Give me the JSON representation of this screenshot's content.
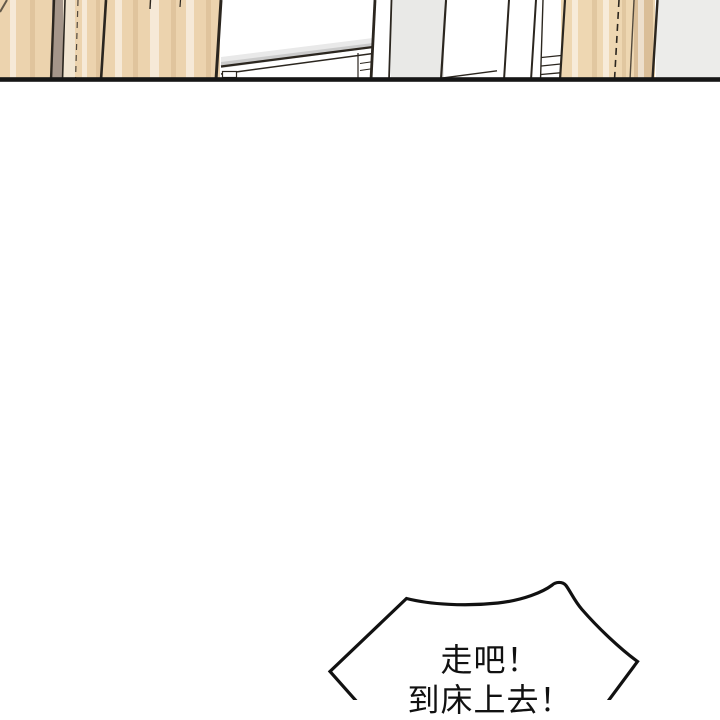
{
  "page": {
    "type": "webtoon-comic-page",
    "background": "#ffffff"
  },
  "panel": {
    "description": "cropped bottom strip of interior artwork: wooden wardrobe panels, white wall with bed edge in perspective, gray wall panels",
    "colors": {
      "wood_light": "#ecd3ae",
      "wood_right": "#eed7b2",
      "shadow_strip_brown": "#a5968a",
      "cream_strip": "#f1e5d1",
      "gray_panel": "#e9e9e7",
      "gray_panel_right": "#ececea",
      "outline_dark": "#2b261f",
      "bottom_border": "#161616"
    }
  },
  "speech_bubble": {
    "line1": "走吧！",
    "line2": "到床上去！",
    "fill": "#ffffff",
    "stroke": "#111111",
    "text_color": "#111111"
  }
}
